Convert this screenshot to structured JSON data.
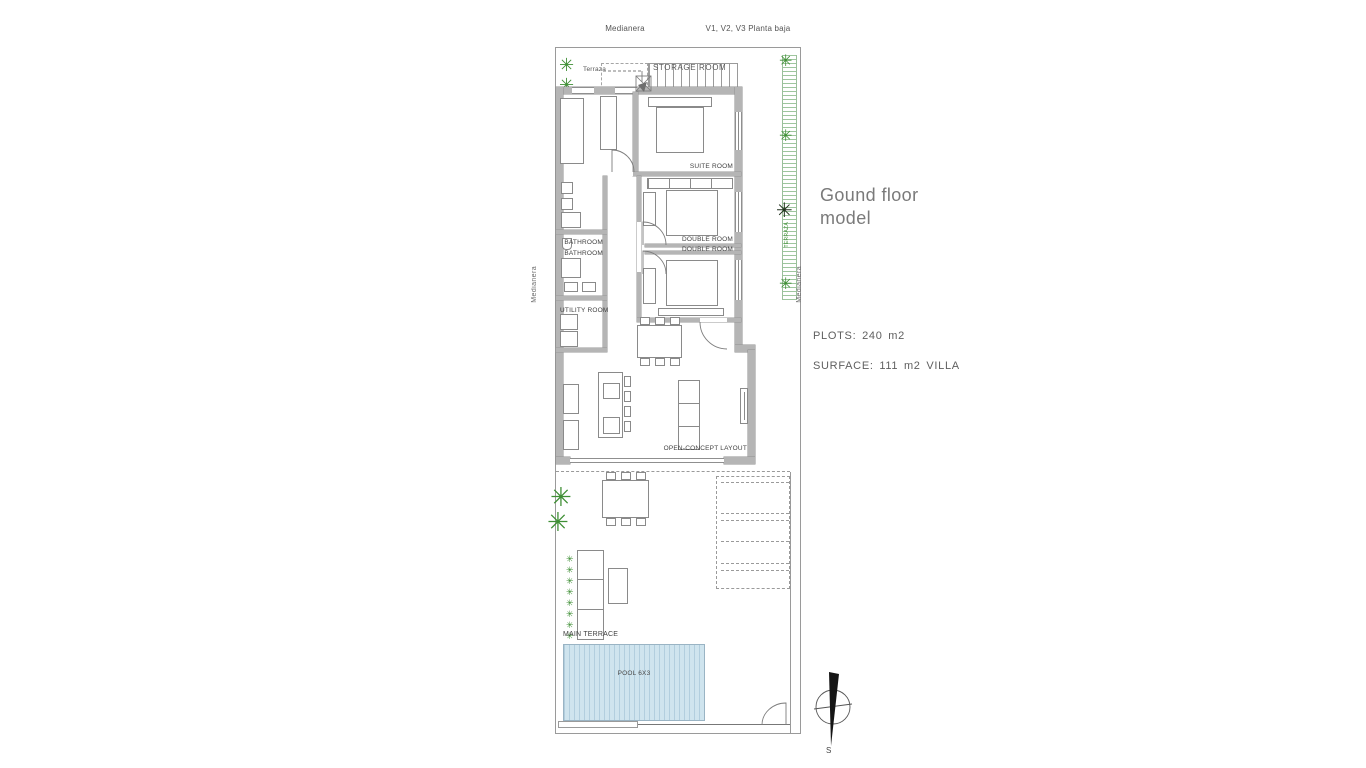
{
  "top": {
    "medianera": "Medianera",
    "planta": "V1, V2, V3 Planta baja"
  },
  "plan": {
    "terraza": "Terraza",
    "storage": "STORAGE ROOM",
    "suite": "SUITE ROOM",
    "bathroom_1": "BATHROOM",
    "bathroom_2": "BATHROOM",
    "double_1": "DOUBLE ROOM",
    "double_2": "DOUBLE ROOM",
    "utility": "UTILITY ROOM",
    "open_concept": "OPEN-CONCEPT LAYOUT",
    "main_terrace": "MAIN TERRACE",
    "pool": "POOL 6X3"
  },
  "side": {
    "left_medianera": "Medianera",
    "right_medianera": "Medianera",
    "hedge_text": "TERRAZA"
  },
  "info": {
    "title_1": "Gound floor",
    "title_2": "model",
    "plots": "PLOTS: 240 m2",
    "surface": "SURFACE: 111 m2 VILLA"
  },
  "compass": {
    "s": "S"
  },
  "icons": {
    "plant": "✳"
  },
  "colors": {
    "wall": "#b5b5b5",
    "line": "#8a8a8a",
    "plant_green": "#3f8f35",
    "plant_dark": "#20301c",
    "pool_fill": "#cfe4ee",
    "pool_stripe": "#aecbdb",
    "hedge_green": "#6aa86a",
    "label_text": "#3f3f3f",
    "title_gray": "#7a7a7a"
  }
}
